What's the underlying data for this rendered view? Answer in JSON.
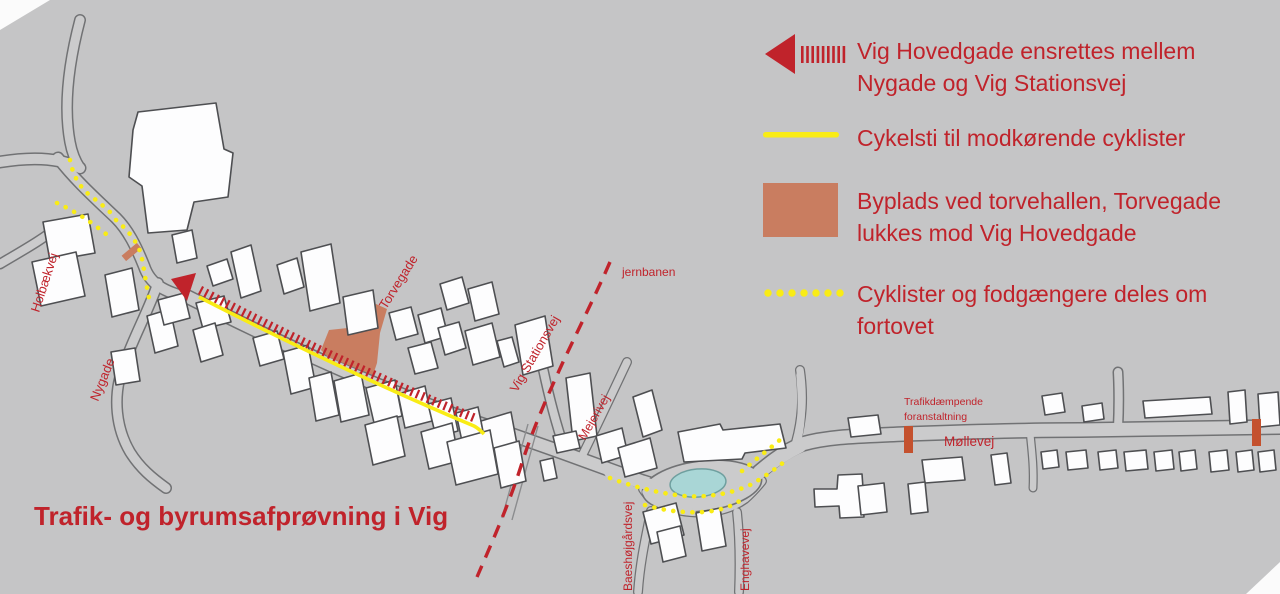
{
  "title": "Trafik- og byrumsafprøvning i Vig",
  "legend": {
    "items": [
      {
        "id": "one-way-street",
        "label": "Vig Hovedgade ensrettes mellem Nygade og Vig Stationsvej"
      },
      {
        "id": "contraflow-bike-lane",
        "label": "Cykelsti til modkørende cyklister"
      },
      {
        "id": "byplads",
        "label": "Byplads ved torvehallen, Torvegade lukkes mod Vig Hovedgade"
      },
      {
        "id": "shared-sidewalk",
        "label": "Cyklister og fodgængere deles om fortovet"
      }
    ]
  },
  "map_labels": {
    "holbaekvej": "Holbækvej",
    "nygade": "Nygade",
    "torvegade": "Torvegade",
    "vig_stationsvej": "Vig Stationsvej",
    "mejerivej": "Mejerivej",
    "jernbanen": "jernbanen",
    "baeshojgardsvej": "Baeshøjgårdsvej",
    "enghavevej": "Enghavevej",
    "mollevej": "Møllevej",
    "trafikdaempende_line1": "Trafikdæmpende",
    "trafikdaempende_line2": "foranstaltning"
  },
  "colors": {
    "red": "#c0232b",
    "yellow": "#f9ec15",
    "salmon": "#c97d60",
    "orange": "#c4512e",
    "pond": "#a9d6d6",
    "pond_edge": "#6f9f9f",
    "bg": "#c5c5c6",
    "road_fill": "#cbcbcc",
    "road_edge": "#717274",
    "ink": "#4e4f52",
    "building": "#fdfdfe"
  }
}
